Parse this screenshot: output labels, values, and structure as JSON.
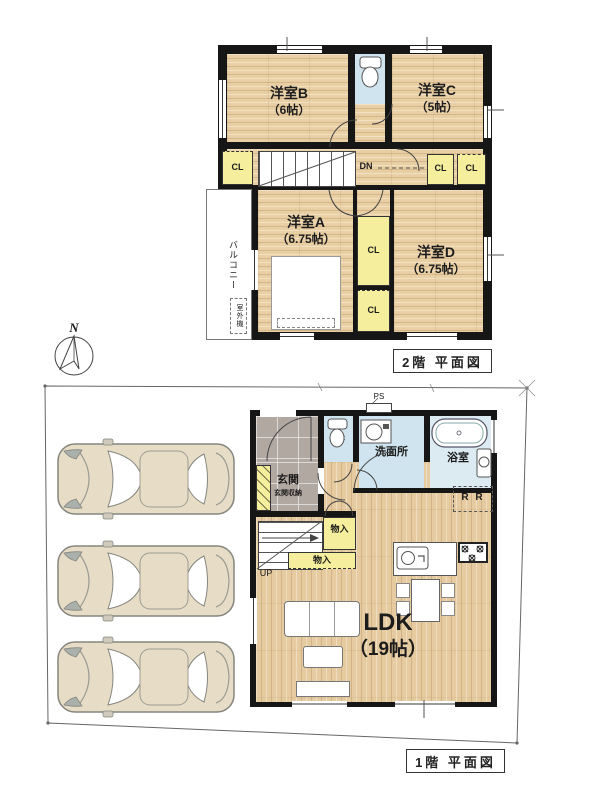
{
  "compass": {
    "label": "N"
  },
  "floor2": {
    "title": "2階 平面図",
    "room_b": {
      "name": "洋室B",
      "size": "（6帖）"
    },
    "room_c": {
      "name": "洋室C",
      "size": "（5帖）"
    },
    "room_a": {
      "name": "洋室A",
      "size": "（6.75帖）"
    },
    "room_d": {
      "name": "洋室D",
      "size": "（6.75帖）"
    },
    "wc": "WC",
    "dn": "DN",
    "balcony": "バルコニー",
    "outdoor_unit": "室外機",
    "closets": [
      "CL",
      "CL",
      "CL",
      "CL",
      "CL"
    ]
  },
  "floor1": {
    "title": "1階 平面図",
    "ldk": {
      "name": "LDK",
      "size": "（19帖）"
    },
    "washroom": "洗面所",
    "bath": "浴室",
    "entrance": "玄関",
    "entrance_storage": "玄関収納",
    "wc": "WC",
    "ps": "PS",
    "up": "UP",
    "fridge": "R R",
    "storages": [
      "物入",
      "物入"
    ]
  },
  "parking": {
    "spaces": [
      {
        "line1": "想定駐車スペース",
        "line2": "4700×2000"
      },
      {
        "line1": "想定駐車スペース",
        "line2": "4700×2000"
      },
      {
        "line1": "想定駐車スペース",
        "line2": "4700×2000"
      }
    ]
  },
  "colors": {
    "wall": "#161616",
    "wood": "#e9cfa4",
    "closet_yellow": "#f5ee9c",
    "water_blue": "#cfe4ee",
    "entrance_tile": "#b2a8a2",
    "car_body": "#e7ddc6"
  }
}
